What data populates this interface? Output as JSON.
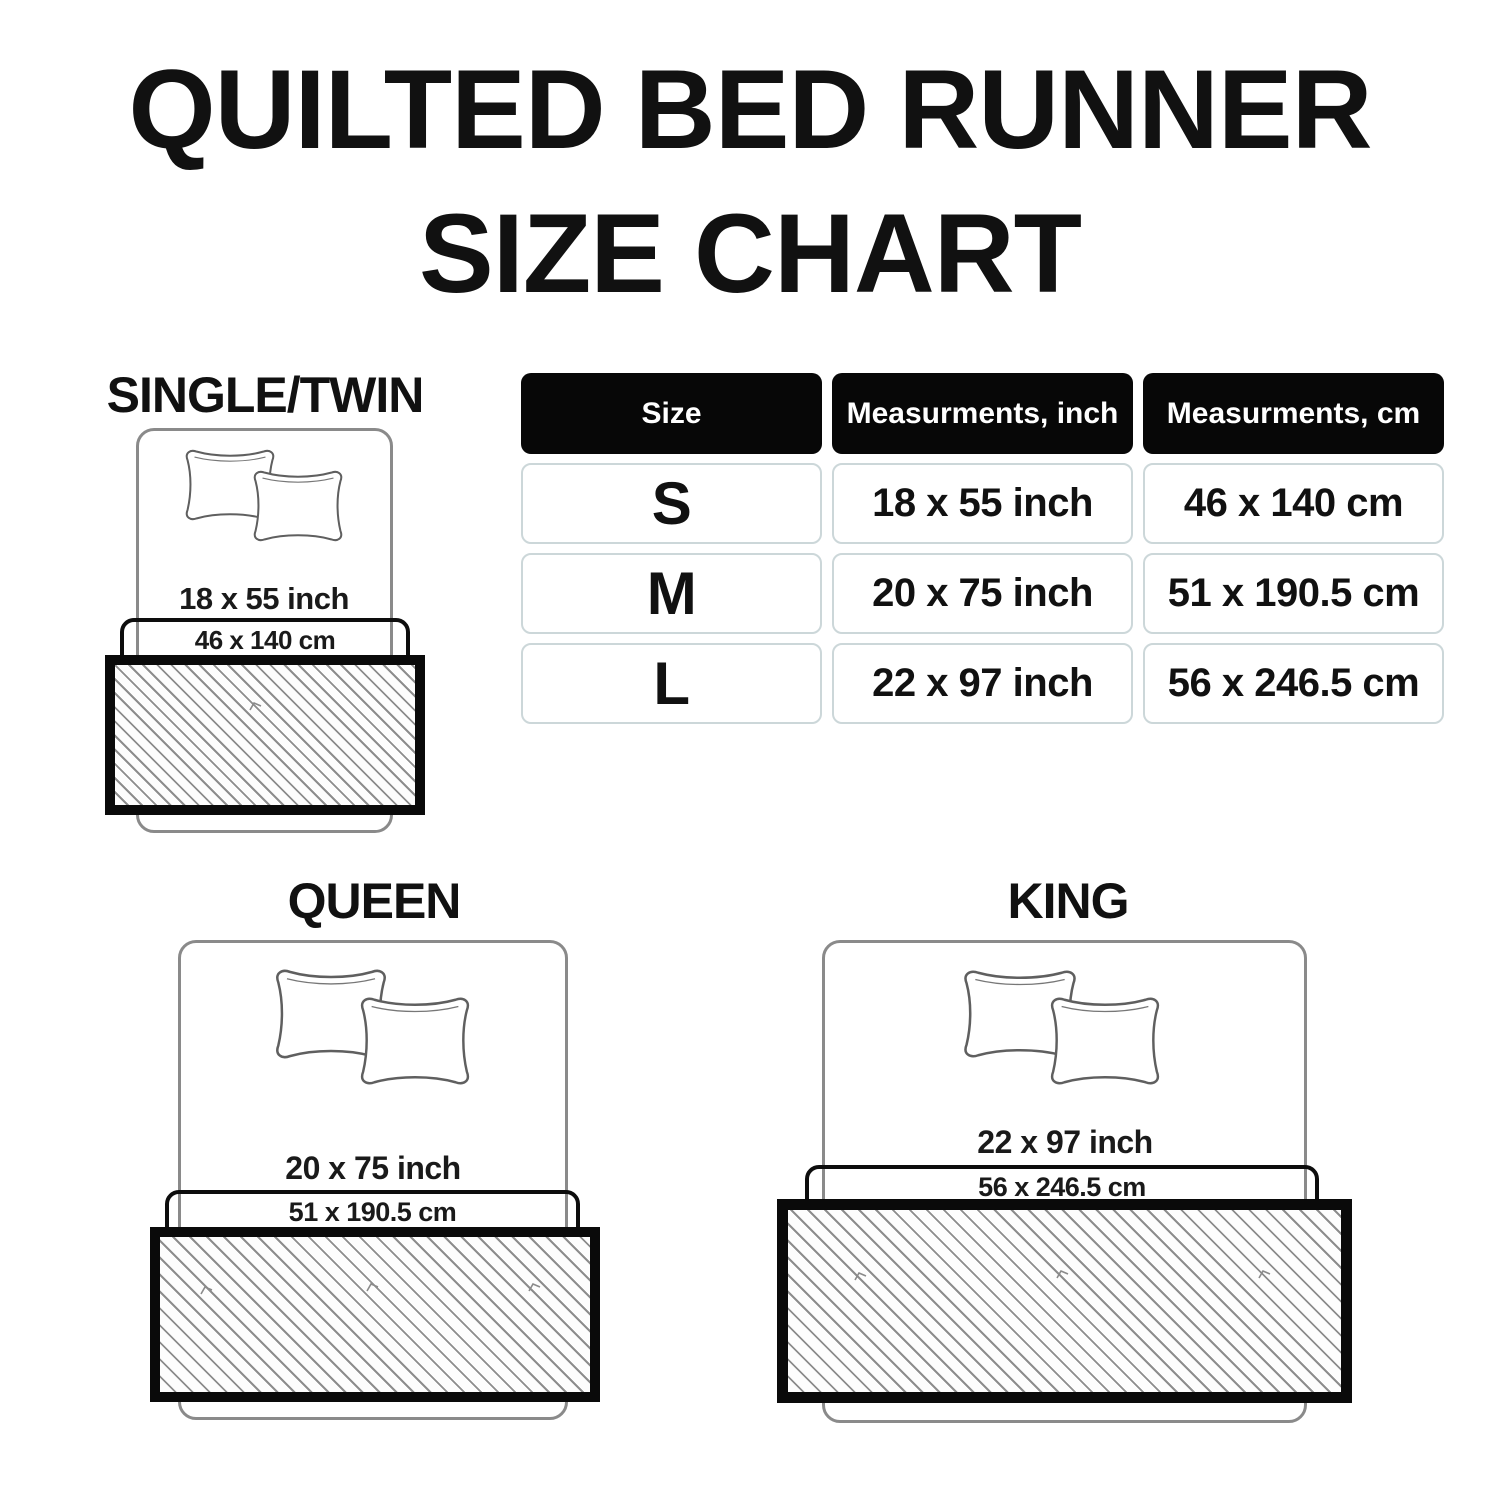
{
  "title": {
    "line1": "QUILTED BED RUNNER",
    "line2": "SIZE CHART"
  },
  "table": {
    "headers": [
      "Size",
      "Measurments, inch",
      "Measurments, cm"
    ],
    "rows": [
      {
        "size": "S",
        "inch": "18 x 55 inch",
        "cm": "46 x 140 cm"
      },
      {
        "size": "M",
        "inch": "20 x 75 inch",
        "cm": "51 x 190.5 cm"
      },
      {
        "size": "L",
        "inch": "22 x 97 inch",
        "cm": "56 x 246.5 cm"
      }
    ]
  },
  "diagrams": [
    {
      "label": "SINGLE/TWIN",
      "inch_size": "18 x 55 inch",
      "cm_size": "46 x 140 cm"
    },
    {
      "label": "QUEEN",
      "inch_size": "20 x 75 inch",
      "cm_size": "51 x 190.5 cm"
    },
    {
      "label": "KING",
      "inch_size": "22 x 97 inch",
      "cm_size": "56 x 246.5 cm"
    }
  ],
  "colors": {
    "background": "#ffffff",
    "text": "#111111",
    "table_header_bg": "#070707",
    "table_header_text": "#ffffff",
    "row_border": "#ccd7d9",
    "bed_outline": "#8a8a8a",
    "runner_border": "#0a0a0a",
    "hatch_line": "#8d8d8d"
  }
}
